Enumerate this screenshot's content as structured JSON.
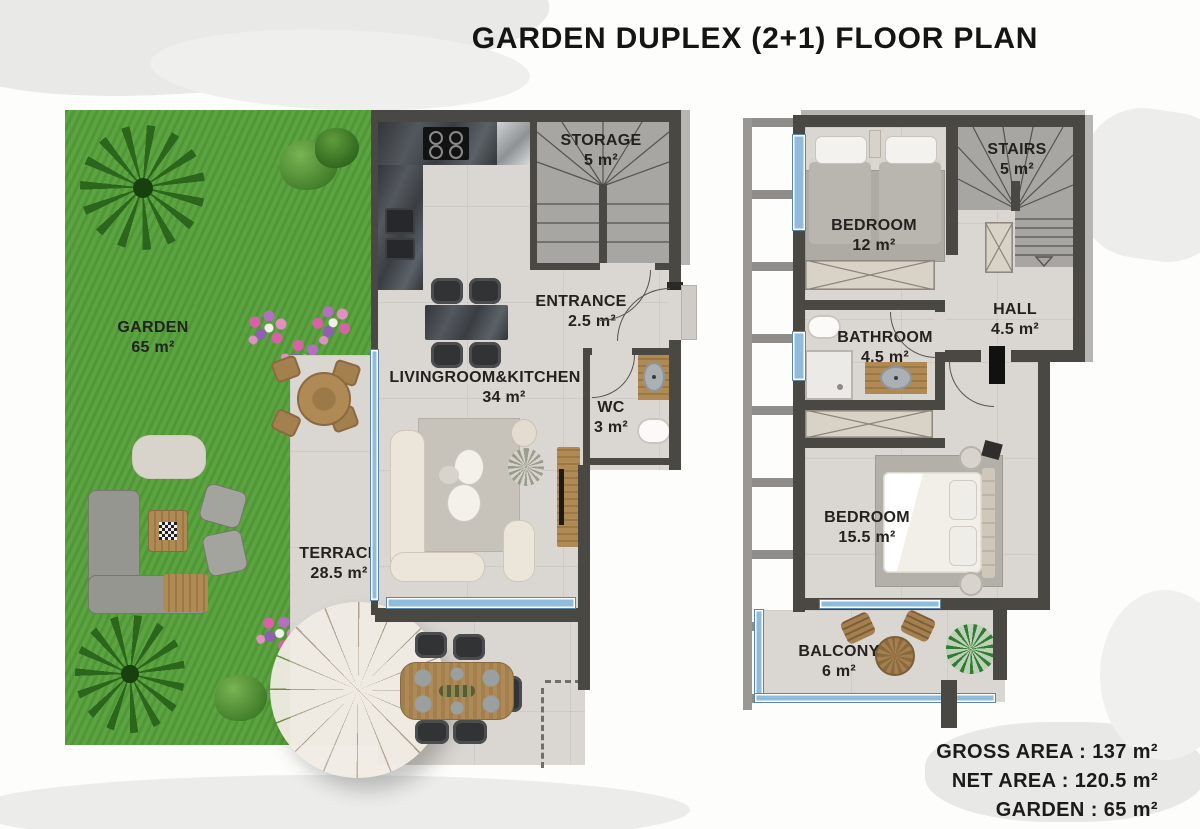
{
  "title": "GARDEN DUPLEX (2+1) FLOOR PLAN",
  "ground_floor": {
    "rooms": {
      "garden": {
        "name": "GARDEN",
        "area": "65 m²"
      },
      "storage": {
        "name": "STORAGE",
        "area": "5 m²"
      },
      "entrance": {
        "name": "ENTRANCE",
        "area": "2.5 m²"
      },
      "living": {
        "name": "LIVINGROOM&KITCHEN",
        "area": "34 m²"
      },
      "wc": {
        "name": "WC",
        "area": "3 m²"
      },
      "terrace": {
        "name": "TERRACE",
        "area": "28.5 m²"
      }
    }
  },
  "upper_floor": {
    "rooms": {
      "bedroom1": {
        "name": "BEDROOM",
        "area": "12 m²"
      },
      "stairs": {
        "name": "STAIRS",
        "area": "5 m²"
      },
      "hall": {
        "name": "HALL",
        "area": "4.5 m²"
      },
      "bathroom": {
        "name": "BATHROOM",
        "area": "4.5 m²"
      },
      "bedroom2": {
        "name": "BEDROOM",
        "area": "15.5 m²"
      },
      "balcony": {
        "name": "BALCONY",
        "area": "6 m²"
      }
    }
  },
  "summary": {
    "gross": {
      "label": "GROSS AREA :",
      "value": "137 m²"
    },
    "net": {
      "label": "NET AREA :",
      "value": "120.5 m²"
    },
    "garden": {
      "label": "GARDEN :",
      "value": "65 m²"
    }
  },
  "colors": {
    "wall": "#4a4843",
    "floor": "#dad6d1",
    "grass": "#57a13b",
    "window_blue": "#8fbbdc",
    "stair_gray": "#a8a6a2",
    "wood": "#b08a55",
    "text": "#23221f"
  }
}
